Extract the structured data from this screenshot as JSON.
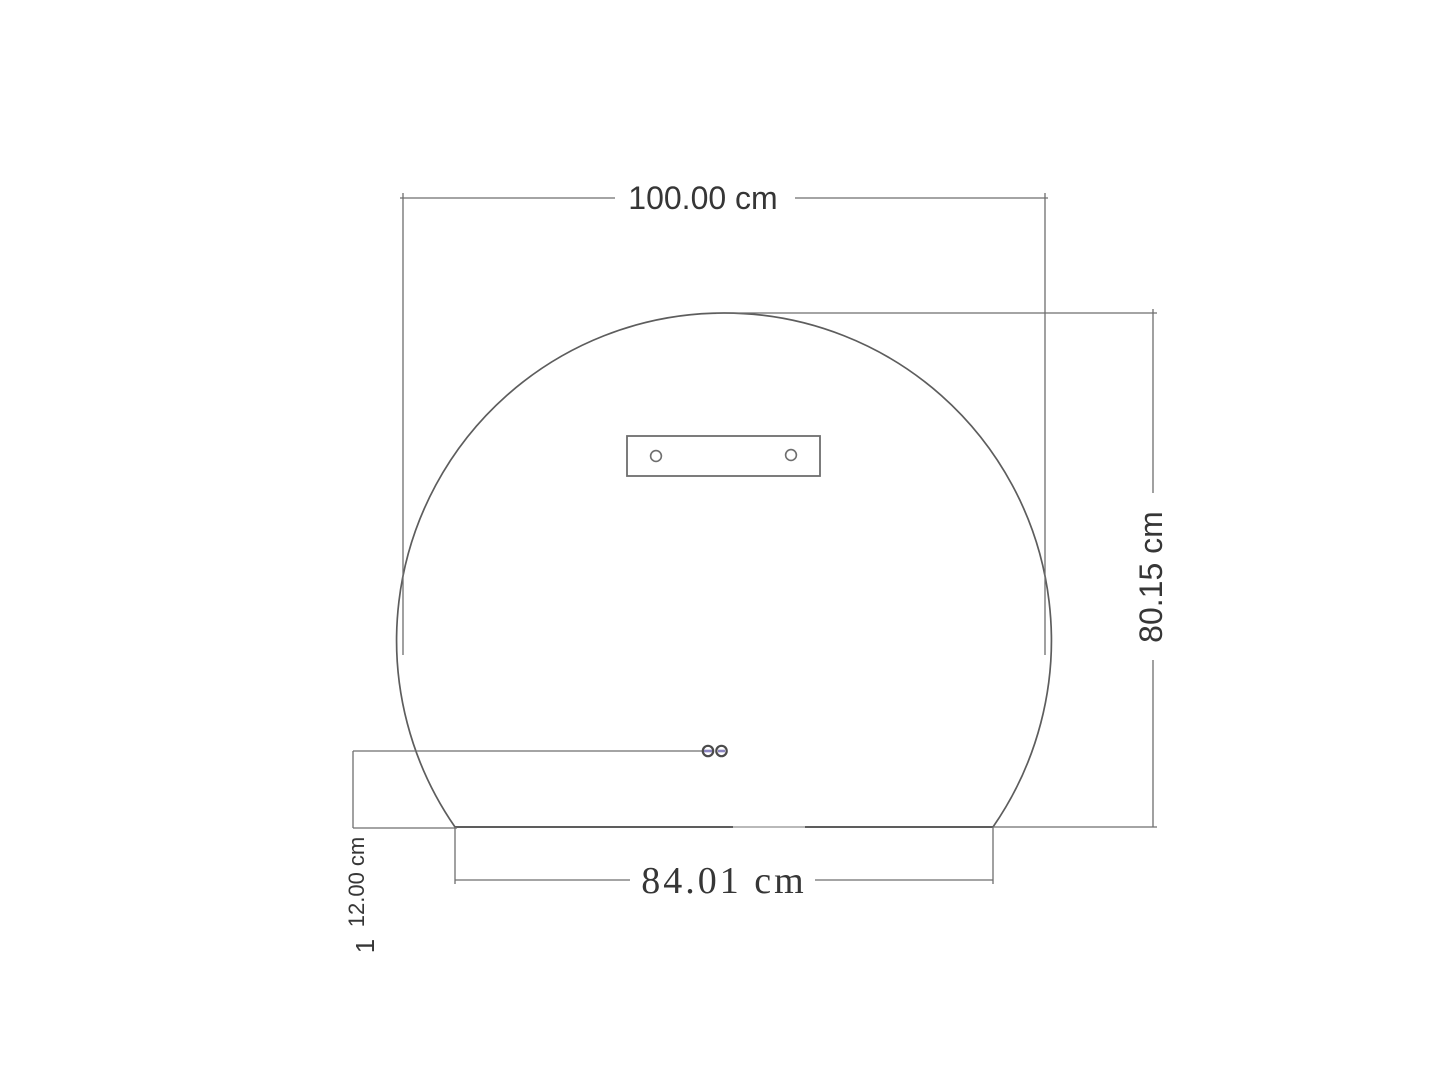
{
  "drawing": {
    "dimensions": {
      "overall_width": "100.00 cm",
      "overall_height": "80.15 cm",
      "base_width": "84.01 cm",
      "sensor_offset": "12.00 cm"
    },
    "page_label": "1",
    "colors": {
      "outline": "#5d5d5d",
      "dim_line": "#6e6e6e",
      "line_light": "#b9b9b9",
      "text": "#363636",
      "sensor_ring": "#4b4b4b",
      "sensor_accent": "#8a84c0",
      "background": "#ffffff"
    }
  }
}
